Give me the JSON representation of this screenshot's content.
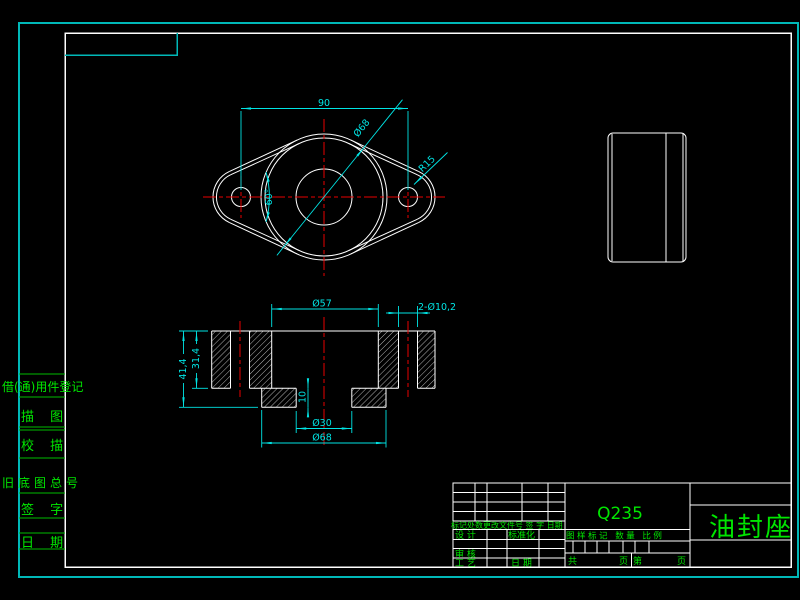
{
  "sheet": {
    "part_name": "油封座",
    "material": "Q235"
  },
  "top_view": {
    "dim_width": "90",
    "dim_boss_dia": "Ø68",
    "dim_radius": "R15",
    "dim_angle": "60°"
  },
  "section_view": {
    "dim_bore": "Ø57",
    "dim_holes": "2-Ø10,2",
    "dim_total_height": "41,4",
    "dim_flange_height": "31,4",
    "dim_recess_depth": "10",
    "dim_recess_dia": "Ø30",
    "dim_boss_dia": "Ø68"
  },
  "left_strip": {
    "labels": [
      "借(通)用件登记",
      "描 图",
      "校 描",
      "旧底图总号",
      "签 字",
      "日 期"
    ]
  },
  "title_block": {
    "material": "Q235",
    "part_name": "油封座",
    "change_row": "标记处数更改文件号 签 字 日期",
    "design": "设 计",
    "standardize": "标准化",
    "audit": "审 核",
    "process": "工 艺",
    "date": "日 期",
    "mark_row": "图样标记 数量 比例",
    "footer": [
      "共",
      "页",
      "第",
      "页"
    ]
  }
}
